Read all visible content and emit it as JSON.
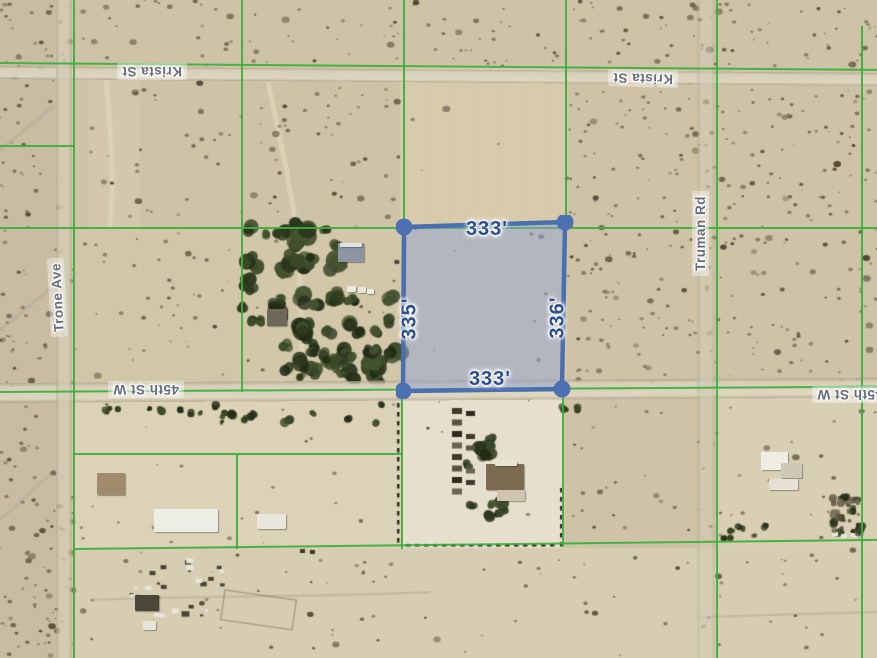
{
  "app": {
    "type": "satellite-parcel-measurement-map"
  },
  "parcel": {
    "top": "333'",
    "right": "336'",
    "bottom": "333'",
    "left": "335'",
    "fill": "rgba(140,158,212,0.48)",
    "stroke": "#4a6fae",
    "dot": "#4d70b2",
    "label_color": "#2d4f8e"
  },
  "streets": {
    "krista": "Krista St",
    "trone": "Trone Ave",
    "truman": "Truman Rd",
    "fortyfifth": "45th St W"
  },
  "colors": {
    "boundary_green": "#3bb03b",
    "terrain_tan": "#cfc3a7",
    "road_tan": "#d8cfb6"
  }
}
